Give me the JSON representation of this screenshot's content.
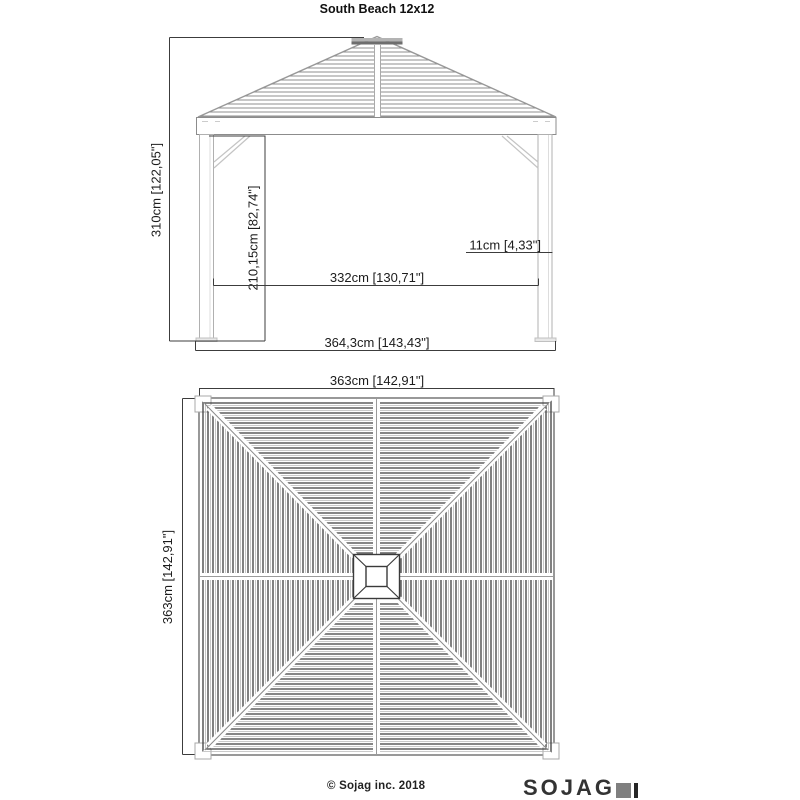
{
  "title": "South Beach 12x12",
  "elevation": {
    "dims": {
      "total_height": "310cm [122,05\"]",
      "clear_height": "210,15cm [82,74\"]",
      "post_width": "11cm [4,33\"]",
      "inner_width": "332cm [130,71\"]",
      "total_width": "364,3cm [143,43\"]"
    }
  },
  "plan": {
    "dims": {
      "width": "363cm [142,91\"]",
      "depth": "363cm [142,91\"]"
    }
  },
  "footer": {
    "copyright": "© Sojag inc. 2018",
    "brand": "SOJAG"
  },
  "colors": {
    "slat_dark": "#3d3d3d",
    "slat_medium": "#8f8f8f",
    "slat_light": "#b8b8b8",
    "structure": "#9a9a9a",
    "dimension": "#3c3c3c",
    "text": "#1c1c1c",
    "logo_gray": "#7f7f7f",
    "logo_dark": "#262626",
    "background": "#ffffff"
  }
}
